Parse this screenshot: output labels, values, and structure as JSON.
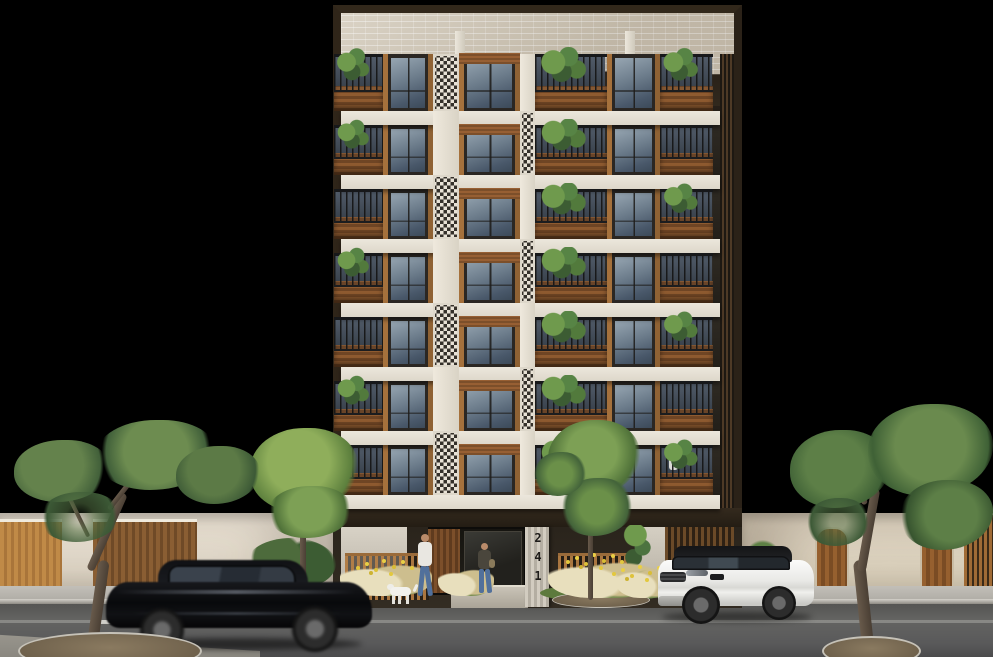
{
  "building": {
    "address": "241",
    "floor_count": 7,
    "floors": [
      {
        "units": [
          {
            "t": "bal",
            "w": 13,
            "plant": true
          },
          {
            "t": "win",
            "w": 13
          },
          {
            "t": "lat",
            "w": 7,
            "checker": true
          },
          {
            "t": "win",
            "w": 16,
            "header": true
          },
          {
            "t": "lat",
            "w": 4
          },
          {
            "t": "bal",
            "w": 19,
            "plant": true
          },
          {
            "t": "win",
            "w": 14
          },
          {
            "t": "bal",
            "w": 14,
            "plant": true
          }
        ]
      },
      {
        "units": [
          {
            "t": "bal",
            "w": 13,
            "plant": true
          },
          {
            "t": "win",
            "w": 13
          },
          {
            "t": "lat",
            "w": 7
          },
          {
            "t": "win",
            "w": 16,
            "header": true
          },
          {
            "t": "lat",
            "w": 4,
            "checker": true
          },
          {
            "t": "bal",
            "w": 19,
            "plant": true
          },
          {
            "t": "win",
            "w": 14
          },
          {
            "t": "bal",
            "w": 14
          }
        ]
      },
      {
        "units": [
          {
            "t": "bal",
            "w": 13
          },
          {
            "t": "win",
            "w": 13
          },
          {
            "t": "lat",
            "w": 7,
            "checker": true
          },
          {
            "t": "win",
            "w": 16,
            "header": true
          },
          {
            "t": "lat",
            "w": 4
          },
          {
            "t": "bal",
            "w": 19,
            "plant": true
          },
          {
            "t": "win",
            "w": 14
          },
          {
            "t": "bal",
            "w": 14,
            "plant": true
          }
        ]
      },
      {
        "units": [
          {
            "t": "bal",
            "w": 13,
            "plant": true
          },
          {
            "t": "win",
            "w": 13
          },
          {
            "t": "lat",
            "w": 7
          },
          {
            "t": "win",
            "w": 16,
            "header": true
          },
          {
            "t": "lat",
            "w": 4,
            "checker": true
          },
          {
            "t": "bal",
            "w": 19,
            "plant": true
          },
          {
            "t": "win",
            "w": 14
          },
          {
            "t": "bal",
            "w": 14
          }
        ]
      },
      {
        "units": [
          {
            "t": "bal",
            "w": 13
          },
          {
            "t": "win",
            "w": 13
          },
          {
            "t": "lat",
            "w": 7,
            "checker": true
          },
          {
            "t": "win",
            "w": 16,
            "header": true
          },
          {
            "t": "lat",
            "w": 4
          },
          {
            "t": "bal",
            "w": 19,
            "plant": true
          },
          {
            "t": "win",
            "w": 14
          },
          {
            "t": "bal",
            "w": 14,
            "plant": true
          }
        ]
      },
      {
        "units": [
          {
            "t": "bal",
            "w": 13,
            "plant": true
          },
          {
            "t": "win",
            "w": 13
          },
          {
            "t": "lat",
            "w": 7
          },
          {
            "t": "win",
            "w": 16,
            "header": true
          },
          {
            "t": "lat",
            "w": 4,
            "checker": true
          },
          {
            "t": "bal",
            "w": 19,
            "plant": true
          },
          {
            "t": "win",
            "w": 14
          },
          {
            "t": "bal",
            "w": 14
          }
        ]
      },
      {
        "units": [
          {
            "t": "bal",
            "w": 13
          },
          {
            "t": "win",
            "w": 13
          },
          {
            "t": "lat",
            "w": 7,
            "checker": true
          },
          {
            "t": "win",
            "w": 16,
            "header": true
          },
          {
            "t": "lat",
            "w": 4
          },
          {
            "t": "bal",
            "w": 19,
            "plant": true
          },
          {
            "t": "win",
            "w": 14
          },
          {
            "t": "bal",
            "w": 14,
            "plant": true
          }
        ]
      }
    ]
  },
  "street": {
    "objects": [
      "neighbor-wall-left",
      "garage-doors",
      "neighbor-wall-right",
      "arched-doors",
      "wood-fence",
      "sidewalk",
      "road",
      "lane-marking",
      "street-tree-left",
      "street-tree-right",
      "yard-tree",
      "entrance-tree",
      "planting-grasses",
      "lawn"
    ],
    "vehicles": [
      "black-sedan-driving",
      "white-suv-parked"
    ],
    "pedestrians": [
      "walker-with-dog",
      "person-at-entrance",
      "person-on-balcony"
    ],
    "animals": [
      "white-dog"
    ]
  },
  "palette": {
    "bg": "#000000",
    "frame": "#2f2519",
    "brick": "#cec4b2",
    "slab": "#e7e2d7",
    "wood": "#a5713c",
    "wood_dark": "#7c4f2a",
    "glass": "#6c7c8b",
    "rail": "#1d1d1d",
    "lattice": "#e8e2d6",
    "plant": "#5d8045",
    "sidewalk": "#b6b3ac",
    "road": "#5f5f5f",
    "lane_line": "#dddcd6",
    "wall_left": "#eae2d4",
    "wall_right": "#e7decd",
    "door_wood": "#a87844",
    "sedan": "#0b0c0e",
    "suv": "#f1f1ef",
    "lawn": "#5d7a3d",
    "grass_tan": "#cdbe8e",
    "flower": "#e3c83e",
    "tree": "#6d8c50",
    "trunk": "#55493d"
  }
}
